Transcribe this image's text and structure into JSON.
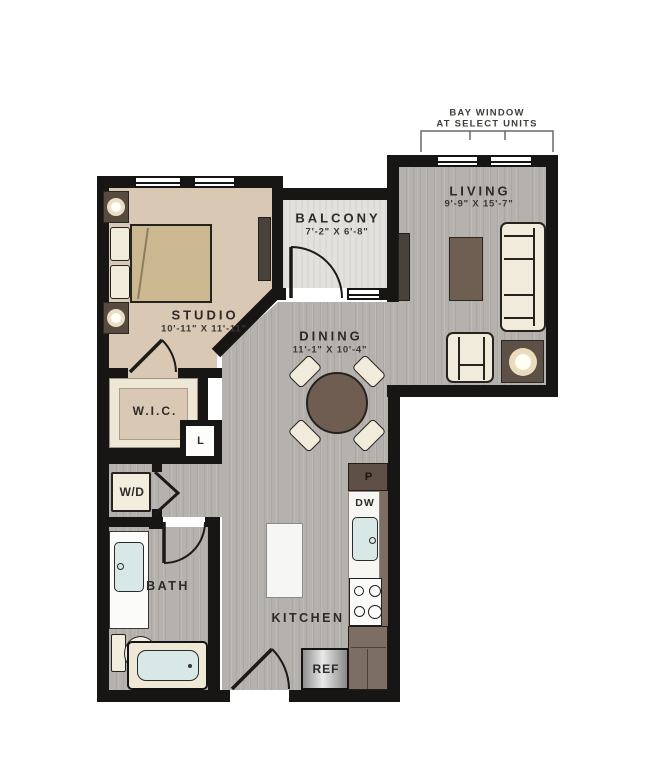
{
  "plan": {
    "annotation": {
      "line1": "BAY WINDOW",
      "line2": "AT SELECT UNITS"
    },
    "rooms": {
      "living": {
        "name": "LIVING",
        "dims": "9'-9\" X 15'-7\""
      },
      "balcony": {
        "name": "BALCONY",
        "dims": "7'-2\" X 6'-8\""
      },
      "studio": {
        "name": "STUDIO",
        "dims": "10'-11\" X 11'-11\""
      },
      "dining": {
        "name": "DINING",
        "dims": "11'-1\" X 10'-4\""
      },
      "wic": {
        "name": "W.I.C."
      },
      "bath": {
        "name": "BATH"
      },
      "kitchen": {
        "name": "KITCHEN"
      }
    },
    "labels": {
      "linen_closet": "L",
      "washer_dryer": "W/D",
      "pantry": "P",
      "dishwasher": "DW",
      "refrigerator": "REF"
    },
    "colors": {
      "wall": "#181614",
      "wood_floor": "#b5b2ad",
      "bedroom_floor": "#d9c8b3",
      "balcony_floor": "#e2e1dd",
      "cream_furniture": "#f1ebdb",
      "brown_furniture": "#6e5f52",
      "fixture_blue": "#d8e8e6",
      "background": "#ffffff"
    }
  }
}
